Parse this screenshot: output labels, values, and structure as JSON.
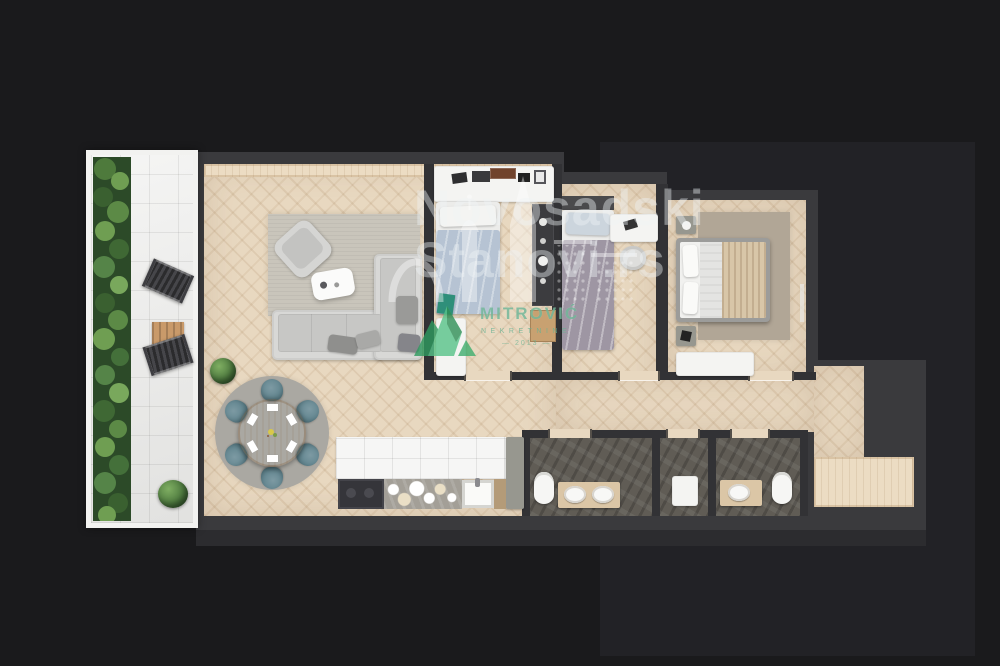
{
  "watermark": {
    "line1": "Novosadski",
    "line2": "Stanovi.rs"
  },
  "logo": {
    "name": "MITROVIĆ",
    "subtitle": "NEKRETNINE",
    "year": "— 2013 —"
  },
  "palette": {
    "background": "#1a1a1c",
    "platform_wall": "#3a3a3d",
    "inner_wall": "#323235",
    "herringbone_floor": "#e8d8c0",
    "terrace_tile": "#ebebe9",
    "hedge_green": "#4e7a3f",
    "bathroom_stone": "#605c55",
    "dining_chair_teal": "#5e828c",
    "duvet_blue": "#b6c3d3",
    "duvet_gray_purple": "#9e96a3",
    "blanket_beige": "#d8c6a8",
    "logo_green": "#68b292",
    "watermark_white": "rgba(238,242,245,0.42)"
  }
}
